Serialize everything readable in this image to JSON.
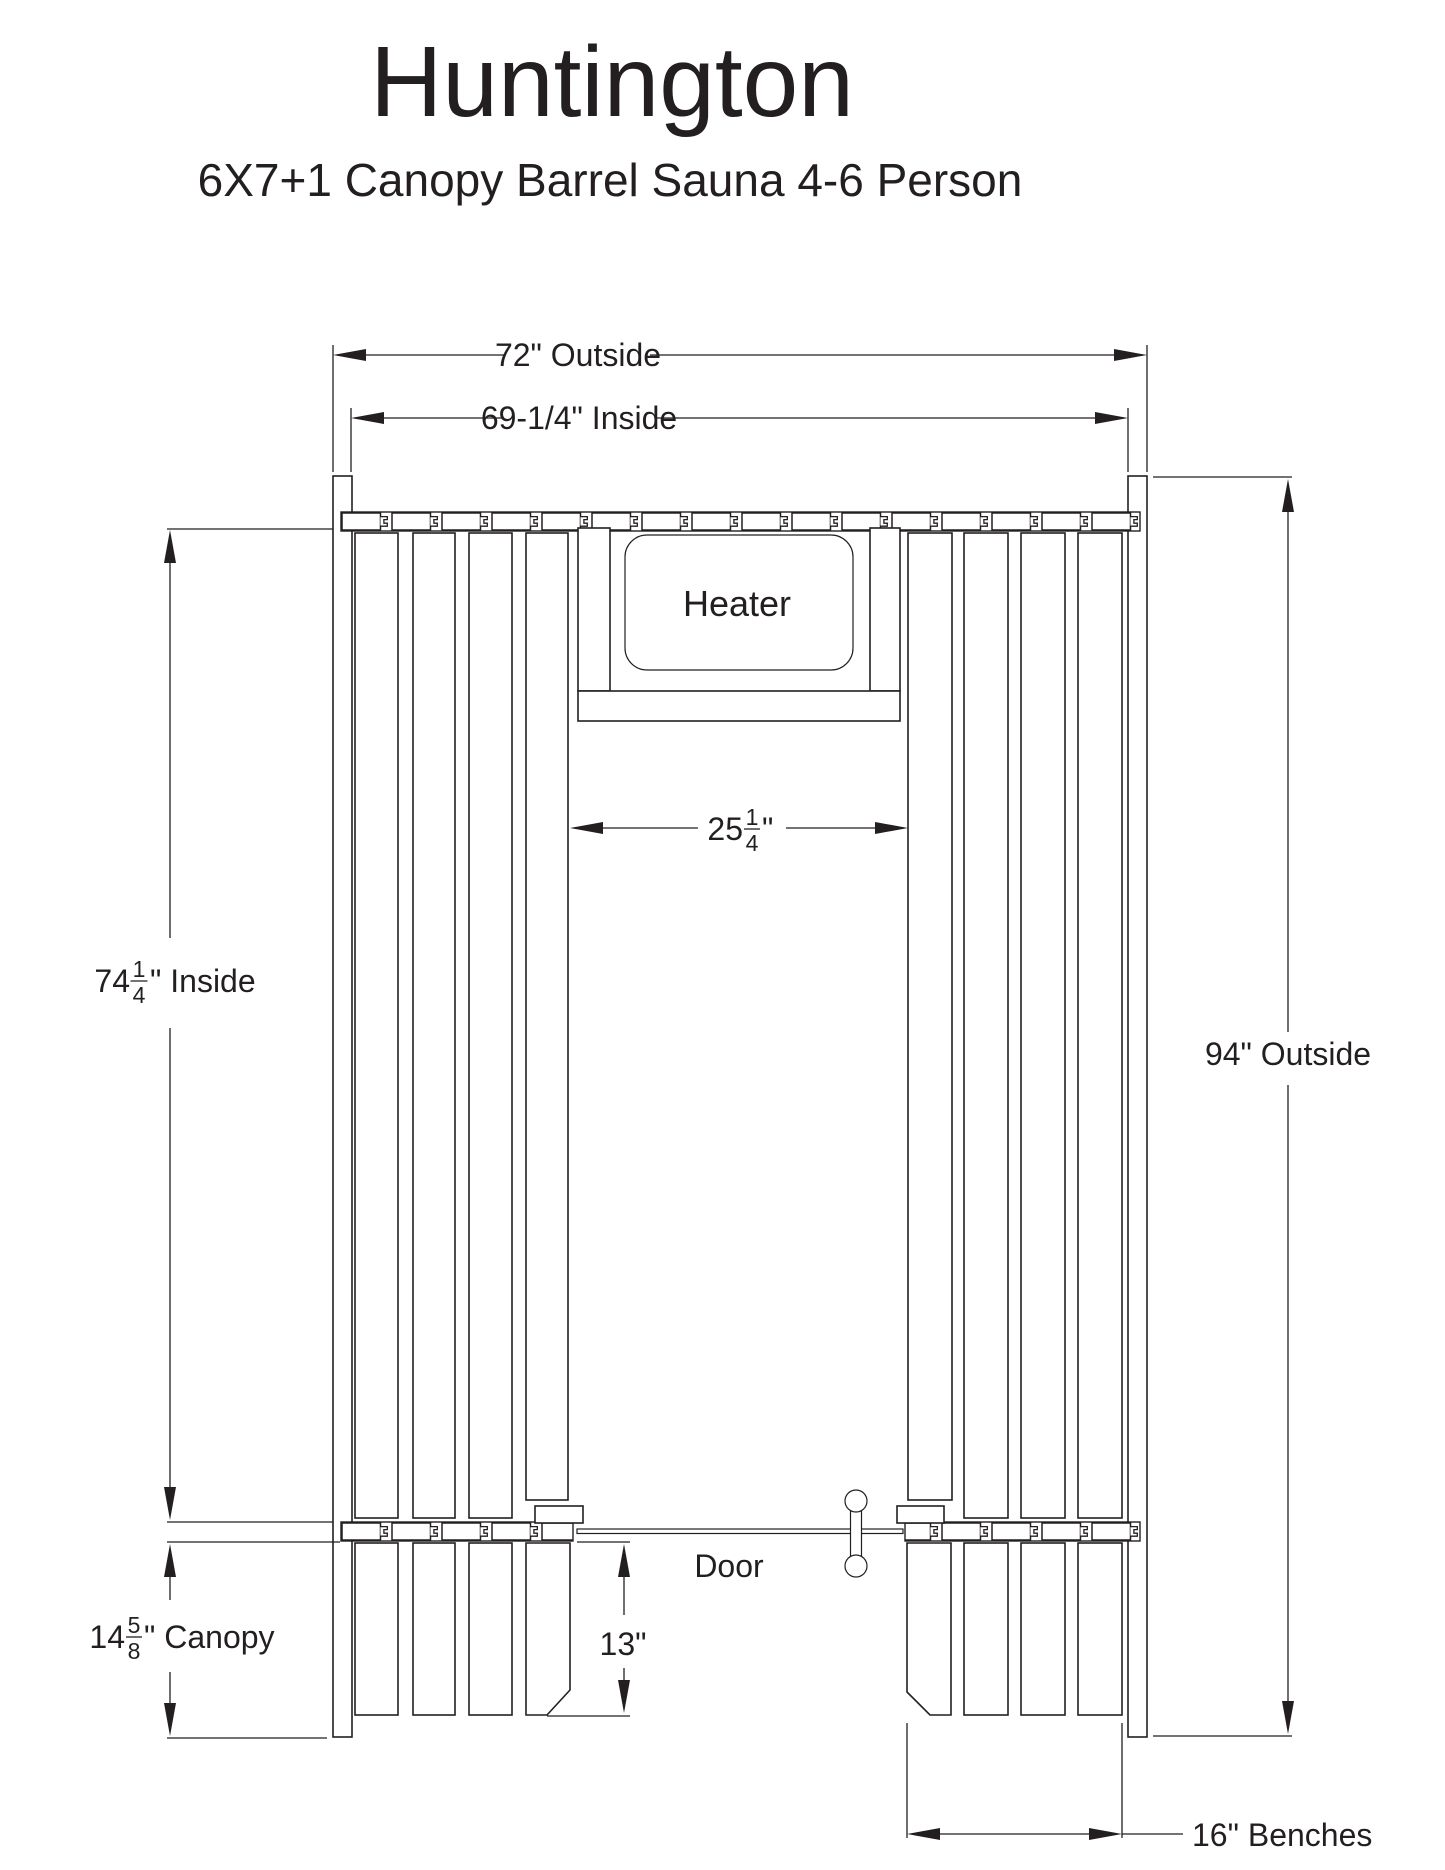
{
  "title": "Huntington",
  "subtitle": "6X7+1 Canopy Barrel Sauna 4-6 Person",
  "drawing": {
    "heater_label": "Heater",
    "door_label": "Door"
  },
  "dimensions": {
    "outside_width": "72\" Outside",
    "inside_width": "69-1/4\" Inside",
    "inside_depth": {
      "whole": "74",
      "numerator": "1",
      "denominator": "4",
      "suffix": "\" Inside"
    },
    "outside_depth": "94\" Outside",
    "walkway_width": {
      "whole": "25",
      "numerator": "1",
      "denominator": "4",
      "suffix": "\""
    },
    "canopy_depth": {
      "whole": "14",
      "numerator": "5",
      "denominator": "8",
      "suffix": "\" Canopy"
    },
    "door_bench_depth": "13\"",
    "bench_width": "16\" Benches"
  },
  "colors": {
    "line": "#231f20",
    "background": "#ffffff"
  }
}
